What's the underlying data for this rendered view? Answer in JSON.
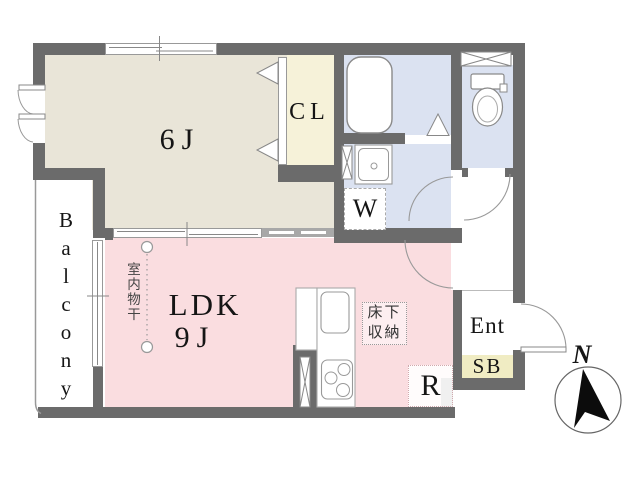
{
  "plan": {
    "rooms": {
      "bedroom": {
        "label": "6J"
      },
      "closet": {
        "label": "CL"
      },
      "living": {
        "label": "LDK",
        "size": "9J"
      },
      "balcony": {
        "label": "Balcony"
      },
      "entrance": {
        "label": "Ent"
      },
      "shoe_box": {
        "label": "SB"
      },
      "washer_space": {
        "label": "W"
      },
      "refrigerator_space": {
        "label": "R"
      },
      "underfloor_storage": {
        "label": "床下収納"
      },
      "indoor_drying_pole": {
        "label": "室内物干"
      }
    },
    "compass": {
      "north_label": "N"
    },
    "colors": {
      "wall": "#6b6b6b",
      "bedroom_floor": "#e9e5d8",
      "closet_floor": "#f6f2d9",
      "wet_area_floor": "#dbe2f1",
      "living_floor": "#fadde0",
      "shoe_box_fill": "#f0ecc3",
      "fixture_outline": "#999999"
    }
  }
}
